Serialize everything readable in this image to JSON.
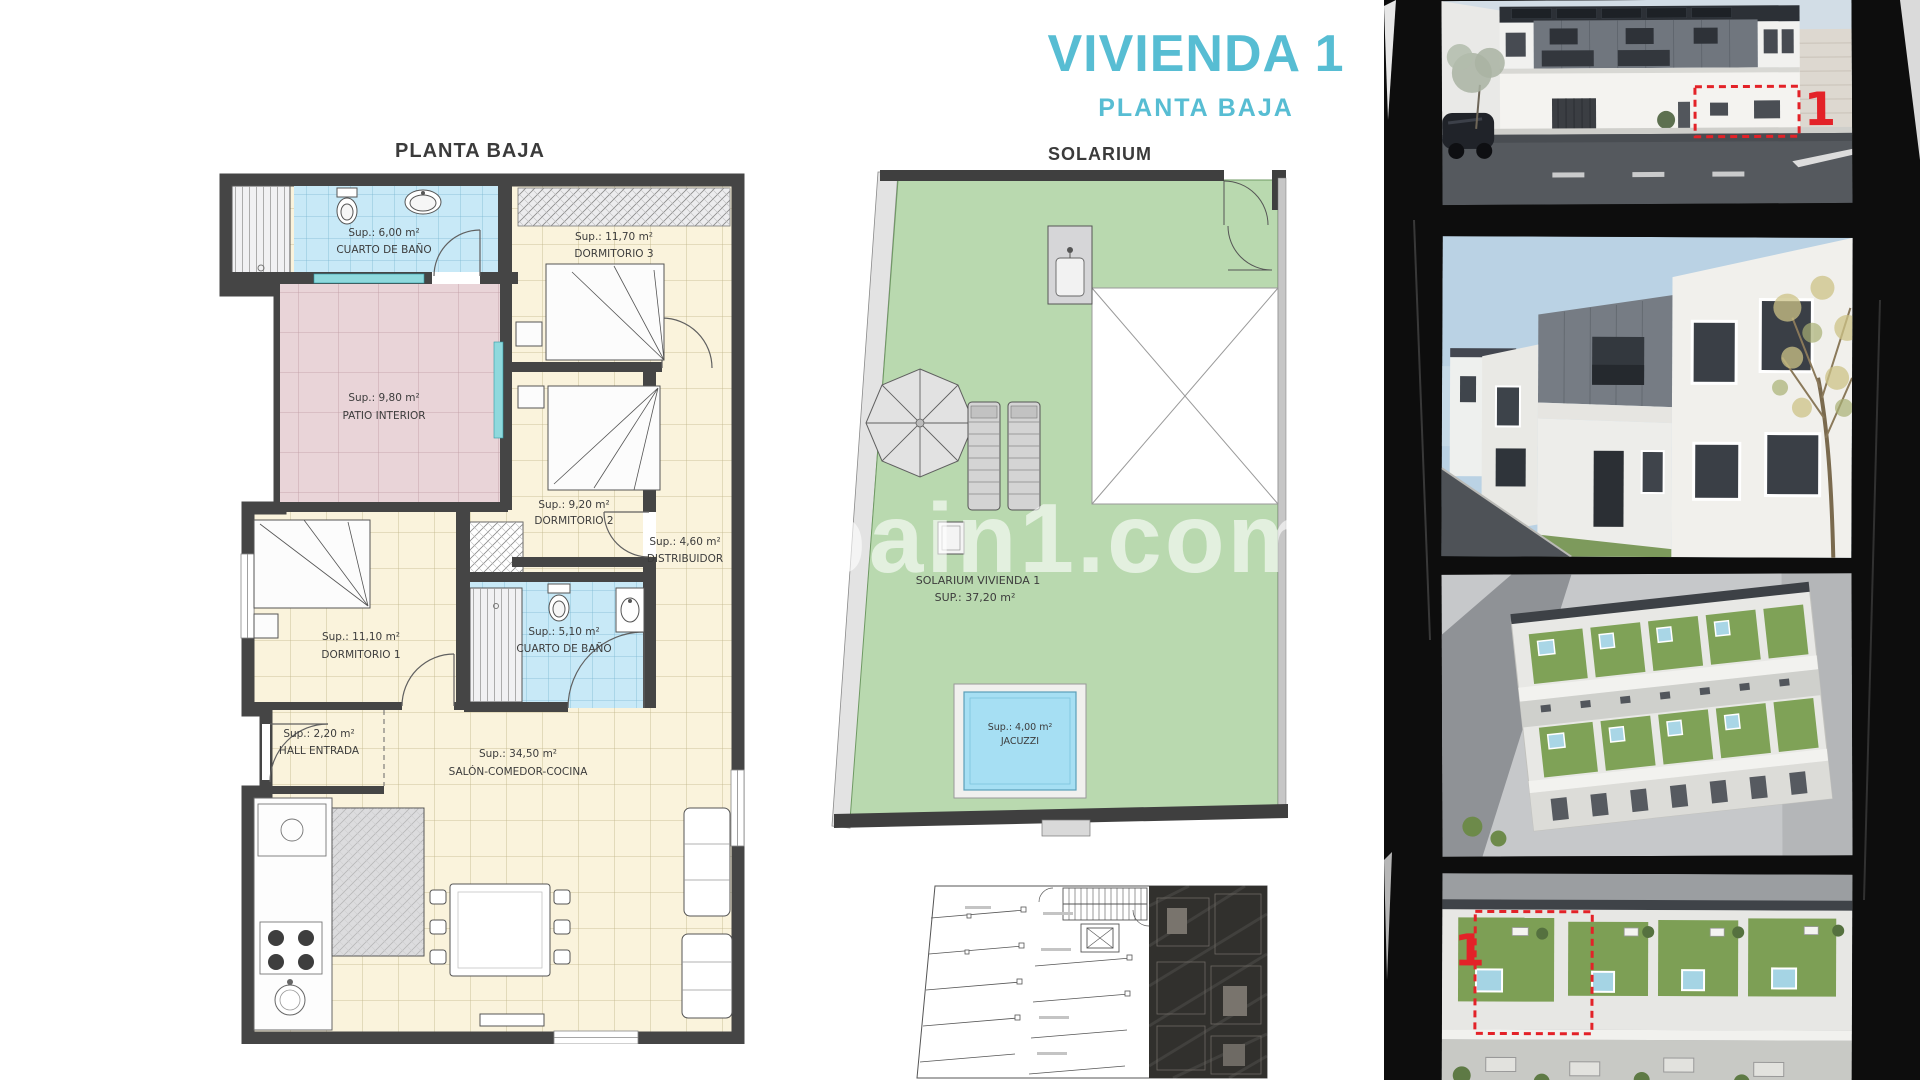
{
  "header": {
    "title": "VIVIENDA 1",
    "subtitle": "PLANTA BAJA"
  },
  "floorplan": {
    "title": "PLANTA BAJA",
    "rooms": {
      "bath1": {
        "area": "Sup.: 6,00 m²",
        "name": "CUARTO DE BAÑO"
      },
      "dorm3": {
        "area": "Sup.: 11,70 m²",
        "name": "DORMITORIO 3"
      },
      "patio": {
        "area": "Sup.: 9,80 m²",
        "name": "PATIO INTERIOR"
      },
      "dorm2": {
        "area": "Sup.: 9,20 m²",
        "name": "DORMITORIO 2"
      },
      "distribuidor": {
        "area": "Sup.: 4,60 m²",
        "name": "DISTRIBUIDOR"
      },
      "dorm1": {
        "area": "Sup.: 11,10 m²",
        "name": "DORMITORIO 1"
      },
      "bath2": {
        "area": "Sup.: 5,10 m²",
        "name": "CUARTO DE BAÑO"
      },
      "hall": {
        "area": "Sup.: 2,20 m²",
        "name": "HALL ENTRADA"
      },
      "salon": {
        "area": "Sup.: 34,50 m²",
        "name": "SALÓN-COMEDOR-COCINA"
      }
    }
  },
  "solarium": {
    "title": "SOLARIUM",
    "room_line1": "SOLARIUM VIVIENDA  1",
    "room_line2": "SUP.: 37,20 m²",
    "jacuzzi_area": "Sup.: 4,00 m²",
    "jacuzzi_name": "JACUZZI"
  },
  "watermark": "pain1.com",
  "gallery": {
    "photo1_marker": "1",
    "photo4_marker": "1"
  },
  "colors": {
    "accent_blue": "#57bdd3",
    "plan_cream": "#faf3dc",
    "plan_blue": "#c8e9f7",
    "plan_pink": "#e9d4d8",
    "solarium_green": "#b9d9af",
    "jacuzzi_blue": "#a6dff3",
    "marker_red": "#e32228",
    "wall_dark": "#454545"
  }
}
